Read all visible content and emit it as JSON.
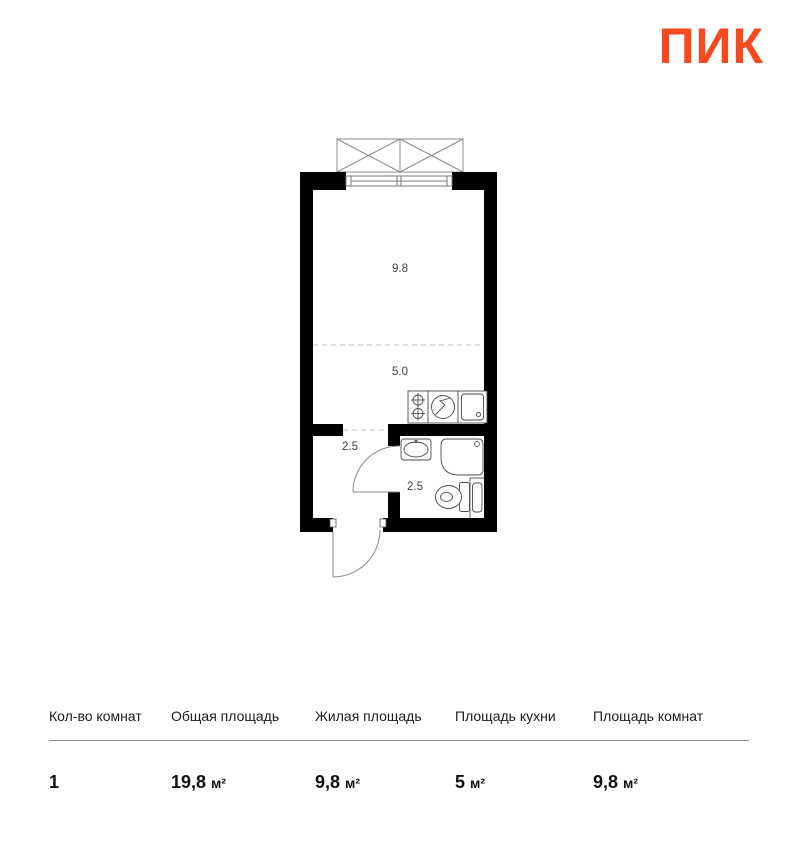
{
  "brand": {
    "logo_text": "ПИК",
    "logo_color": "#F6491D"
  },
  "floorplan": {
    "room_labels": {
      "living_room": "9.8",
      "kitchen": "5.0",
      "hallway": "2.5",
      "bathroom": "2.5"
    }
  },
  "summary_table": {
    "columns": [
      {
        "label": "Кол-во комнат",
        "value": "1",
        "unit": ""
      },
      {
        "label": "Общая площадь",
        "value": "19,8",
        "unit": "м²"
      },
      {
        "label": "Жилая площадь",
        "value": "9,8",
        "unit": "м²"
      },
      {
        "label": "Площадь кухни",
        "value": "5",
        "unit": "м²"
      },
      {
        "label": "Площадь комнат",
        "value": "9,8",
        "unit": "м²"
      }
    ]
  }
}
